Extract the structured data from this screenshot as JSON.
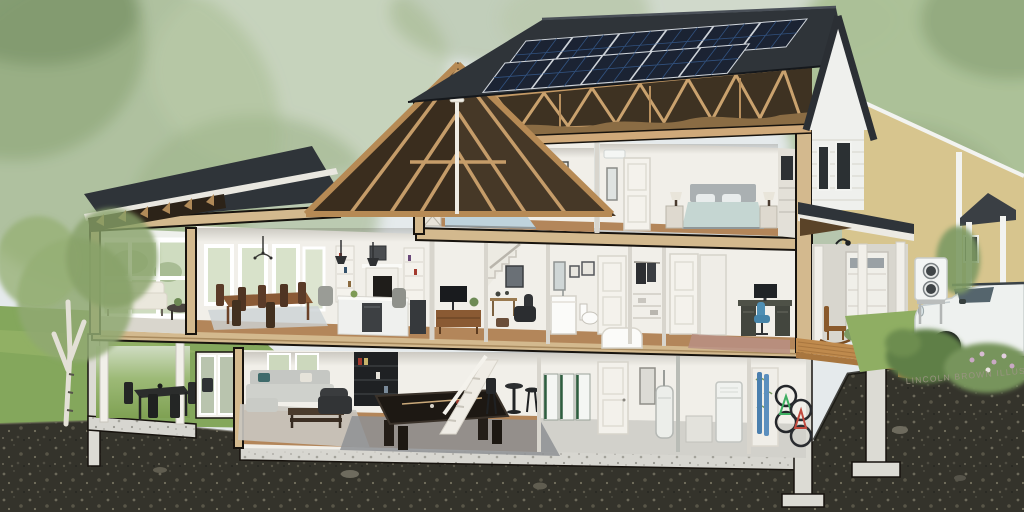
{
  "watermark": {
    "text": "LINCOLN BROWN ILLUSTRATION"
  },
  "scene": {
    "type": "cutaway-cross-section-house-illustration",
    "floors": [
      "attic-with-trusses",
      "upper-floor-bedrooms",
      "main-floor-living",
      "basement"
    ],
    "rooms": [
      "sunroom",
      "dining-room",
      "kitchen-living-room",
      "tv-room",
      "hallway-stairs",
      "bathroom",
      "closet",
      "home-office",
      "bedroom-left",
      "bedroom-right",
      "patio",
      "rec-room",
      "utility-room",
      "storage-nook",
      "garage-porch"
    ],
    "energy_features": [
      "rooftop-solar-array",
      "mini-split-head",
      "outdoor-heat-pump-unit",
      "home-battery-bank",
      "heat-pump-water-heater",
      "electric-suv",
      "blown-attic-insulation"
    ]
  },
  "solar_array": {
    "rows": 2,
    "panels_top_row": 6,
    "panels_bottom_row": 5
  },
  "battery_modules": 3,
  "palette": {
    "sky": "#e5eaec",
    "foliage": "#a7bb92",
    "foliage_deep": "#7f976a",
    "lawn": "#84a75c",
    "soil": "#34332b",
    "roof": "#2f3439",
    "solar": "#1b2333",
    "wood": "#c49a66",
    "wood_dark": "#7a5c38",
    "cut": "#d3b98e",
    "siding": "#eff0ed",
    "neighbor": "#d7c58e",
    "concrete": "#dcdbd4",
    "deck": "#bf8a4d",
    "wall": "#f1efe9",
    "floor": "#b3865a",
    "insulation": "#8a6c44",
    "heatpump": "#f3f5f4",
    "suv": "#eef1ef",
    "battery_accent": "#2e5e40",
    "watermark": "#9b9483"
  }
}
